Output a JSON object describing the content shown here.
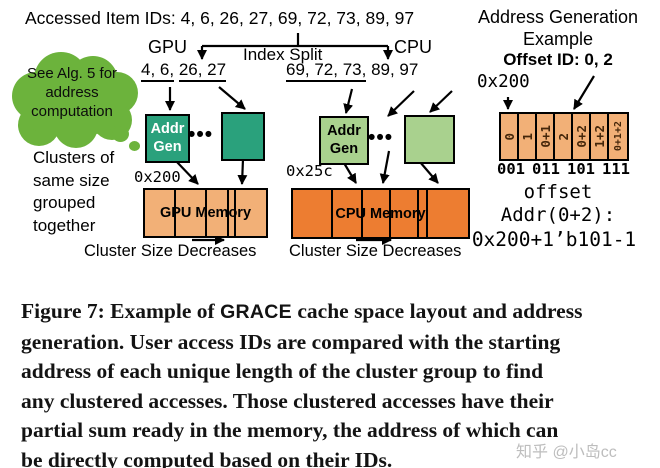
{
  "colors": {
    "teal_box": "#2aa17c",
    "light_green_box": "#a9d18e",
    "gpu_memory_orange": "#f2b077",
    "cpu_memory_orange": "#ed7d31",
    "cloud_green": "#6cb33c",
    "offset_cell_orange": "#f2b077"
  },
  "diagram": {
    "accessed_ids_label": "Accessed Item IDs:",
    "accessed_ids_values": "4, 6, 26, 27, 69, 72, 73, 89, 97",
    "index_split": {
      "gpu_label": "GPU",
      "label": "Index Split",
      "cpu_label": "CPU"
    },
    "cloud_note": [
      "See Alg. 5 for",
      "address",
      "computation"
    ],
    "clusters_note": [
      "Clusters of",
      "same size",
      "grouped",
      "together"
    ],
    "gpu": {
      "ids_group1": "4, 6,",
      "ids_group2": "26, 27",
      "addr_gen": [
        "Addr",
        "Gen"
      ],
      "dots": "•••",
      "base_addr": "0x200",
      "memory_label": "GPU Memory",
      "cluster_size_note": "Cluster Size Decreases",
      "cell_widths": [
        31,
        31,
        22,
        7,
        18
      ]
    },
    "cpu": {
      "ids_group1": "69, 72, 73,",
      "ids_group2": "89, 97",
      "addr_gen": [
        "Addr",
        "Gen"
      ],
      "dots": "•••",
      "base_addr": "0x25c",
      "memory_label": "CPU Memory",
      "cluster_size_note": "Cluster Size Decreases",
      "cell_widths": [
        40,
        30,
        28,
        28,
        9,
        26
      ]
    }
  },
  "address_example": {
    "title_line1": "Address Generation",
    "title_line2": "Example",
    "offset_id_label": "Offset ID: 0, 2",
    "base_addr": "0x200",
    "cells": [
      "0",
      "1",
      "0+1",
      "2",
      "0+2",
      "1+2",
      "0+1+2"
    ],
    "binary_labels": [
      "001",
      "011",
      "101",
      "111"
    ],
    "offset_label": "offset",
    "addr_formula_line1": "Addr(0+2):",
    "addr_formula_line2": "0x200+1’b101-1"
  },
  "caption": {
    "line1_pre": "Figure 7: Example of ",
    "line1_grace": "GRACE",
    "line1_post": " cache space layout and address",
    "line2": "generation. User access IDs are compared with the starting",
    "line3": "address of each unique length of the cluster group to find",
    "line4": "any clustered accesses. Those clustered accesses have their",
    "line5": "partial sum ready in the memory, the address of which can",
    "line6": "be directly computed based on their IDs."
  },
  "watermark": "知乎 @小岛cc"
}
